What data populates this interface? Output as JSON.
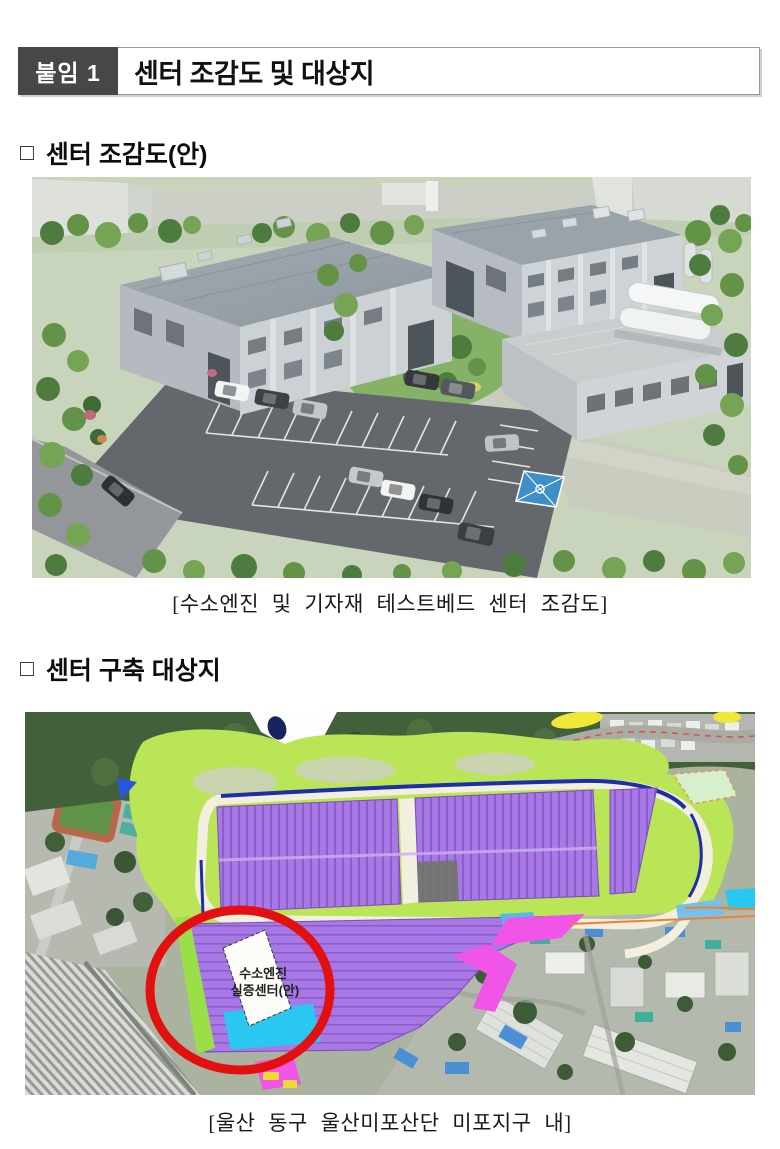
{
  "header": {
    "badge_label": "붙임 1",
    "title": "센터 조감도 및 대상지",
    "badge_bg": "#474747"
  },
  "sections": {
    "birdseye": {
      "bullet": "□",
      "heading": "센터 조감도(안)",
      "caption": "[수소엔진 및 기자재 테스트베드 센터 조감도]"
    },
    "site": {
      "bullet": "□",
      "heading": "센터 구축 대상지",
      "caption": "[울산 동구 울산미포산단 미포지구 내]"
    }
  },
  "map_figure": {
    "site_label_line1": "수소엔진",
    "site_label_line2": "실증센터(안)",
    "highlight_color": "#e31010",
    "zone_colors": {
      "industrial_lot": "#a878e4",
      "greenbelt": "#b9e556",
      "commercial": "#f055e8",
      "support": "#2ac8f0"
    }
  }
}
